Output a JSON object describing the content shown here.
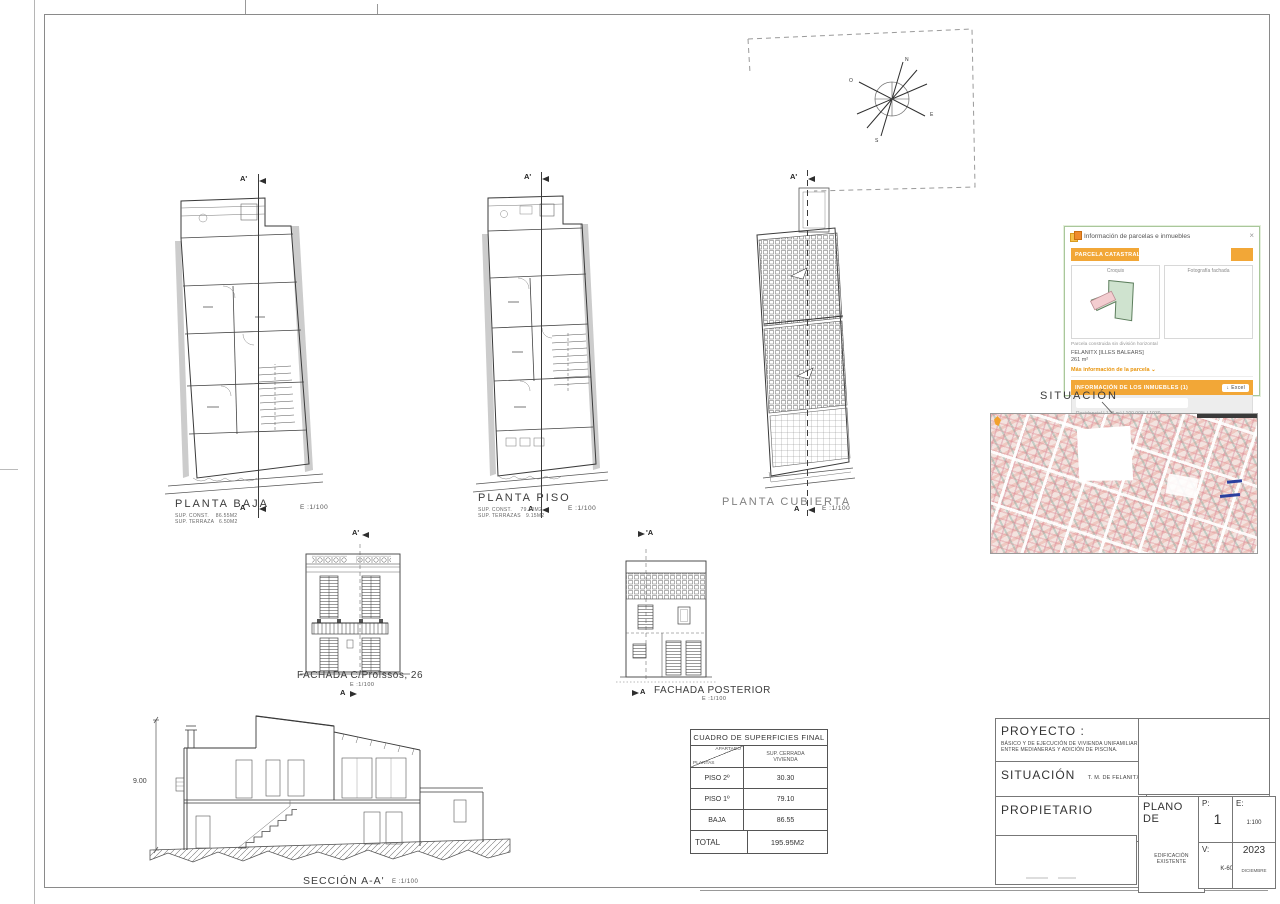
{
  "plans": {
    "baja": {
      "title": "PLANTA BAJA",
      "sup": "SUP. CONST.    86.55M2\nSUP. TERRAZA   6.50M2",
      "scale": "E :1/100",
      "sec_top": "A'",
      "sec_bot": "A"
    },
    "piso": {
      "title": "PLANTA PISO",
      "sup": "SUP. CONST.     79.10M2\nSUP. TERRAZAS   9.15M2",
      "scale": "E :1/100",
      "sec_top": "A'",
      "sec_bot": "A"
    },
    "cubierta": {
      "title": "PLANTA CUBIERTA",
      "scale": "E :1/100",
      "sec_top": "A'",
      "sec_bot": "A"
    }
  },
  "facades": {
    "front": {
      "title": "FACHADA C/Proïssos, 26",
      "scale": "E :1/100",
      "sec_top": "A'",
      "sec_bot": "A"
    },
    "rear": {
      "title": "FACHADA POSTERIOR",
      "scale": "E :1/100",
      "sec_top": "'A",
      "sec_bot": "A"
    }
  },
  "section": {
    "title": "SECCIÓN A-A'",
    "scale": "E :1/100",
    "height_dim": "9.00"
  },
  "situacion_label": "SITUACIÓN",
  "compass": {
    "n": "N",
    "e": "E",
    "s": "S",
    "w": "O"
  },
  "surfaces_table": {
    "title": "CUADRO DE SUPERFICIES FINAL",
    "diag_top": "APARTADO",
    "diag_bottom": "PLANTAS",
    "col_header": "SUP. CERRADA VIVIENDA",
    "rows": [
      {
        "label": "PISO 2º",
        "value": "30.30"
      },
      {
        "label": "PISO 1º",
        "value": "79.10"
      },
      {
        "label": "BAJA",
        "value": "86.55"
      }
    ],
    "total_label": "TOTAL",
    "total_value": "195.95M2"
  },
  "popup": {
    "title": "Información de parcelas e inmuebles",
    "parcel_bar": "PARCELA CATASTRAL",
    "croquis_caption": "Croquis",
    "foto_caption": "Fotografía fachada",
    "parcel_note": "Parcela construida sin división horizontal",
    "municipality": "FELANITX [ILLES BALEARS]",
    "area": "261 m²",
    "more_link": "Más información de la parcela",
    "inmuebles_bar": "INFORMACIÓN DE LOS INMUEBLES (1)",
    "excel_button": "Excel",
    "inmueble_row": "Residencial | 178 m² | 100,00% | 1939",
    "accent": "#f2a737"
  },
  "icons": {
    "close": "×",
    "chevron_down": "⌄",
    "download": "↓"
  },
  "titleblock": {
    "proyecto_label": "PROYECTO :",
    "proyecto_text": "BÁSICO Y DE EJECUCIÓN DE VIVIENDA UNIFAMILIAR ENTRE MEDIANERAS Y ADICIÓN DE PISCINA.",
    "situacion_label": "SITUACIÓN",
    "situacion_value": "T. M. DE FELANITX",
    "propietario_label": "PROPIETARIO",
    "plano_label": "PLANO DE",
    "plano_value": "EDIFICACIÓN EXISTENTE",
    "p_label": "P:",
    "p_value": "1",
    "e_label": "E:",
    "e_value": "1:100",
    "v_label": "V:",
    "v_value": "K-60",
    "year": "2023",
    "month": "DICIEMBRE"
  }
}
